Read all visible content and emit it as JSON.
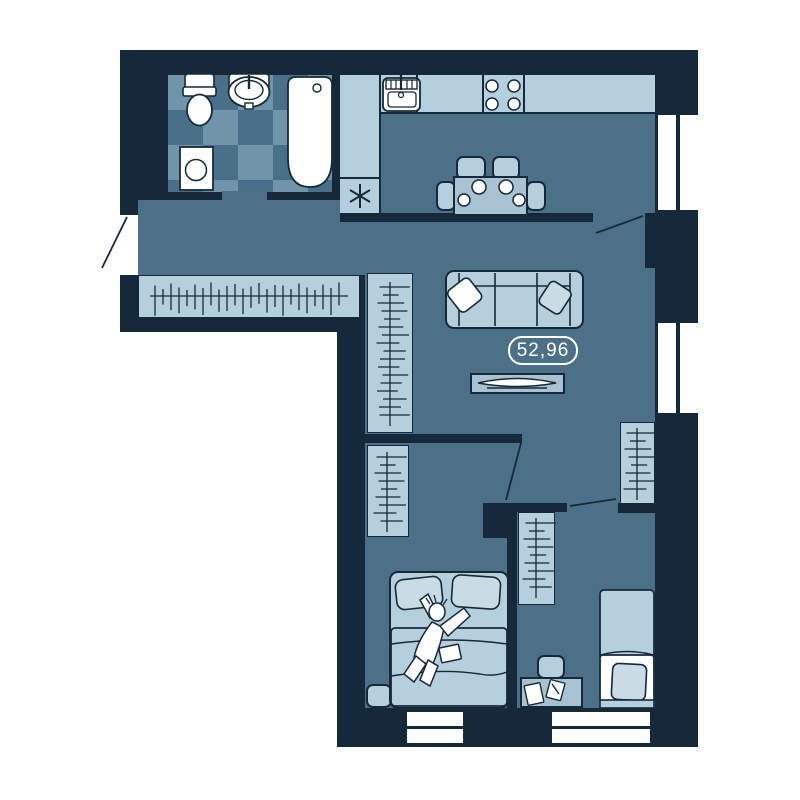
{
  "title": "Apartment floor plan",
  "area_label": {
    "value": "52,96"
  },
  "palette": {
    "wall": "#16293a",
    "floor": "#4b7087",
    "light": "#b6cfdc",
    "mid": "#a8c2d2",
    "pale": "#c9dbe5",
    "tile_light": "#7095aa",
    "tile_dark": "#4a7089",
    "white": "#ffffff"
  },
  "rooms": {
    "bathroom": {
      "fixtures": [
        "toilet",
        "washbasin",
        "bathtub",
        "washing-machine",
        "checker-tiled-floor"
      ]
    },
    "hallway": {
      "fixtures": [
        "entrance-door",
        "coat-rack"
      ]
    },
    "kitchen": {
      "fixtures": [
        "counter",
        "kitchen-sink",
        "stove-4-burner",
        "refrigerator-asterisk",
        "dining-table",
        "four-chairs",
        "door"
      ]
    },
    "living_room": {
      "fixtures": [
        "sofa",
        "two-pillows",
        "tv-stand",
        "wardrobe"
      ],
      "area_label": "52,96"
    },
    "bedroom_1": {
      "fixtures": [
        "double-bed",
        "person-on-bed",
        "two-wardrobes",
        "nightstand",
        "pouf",
        "door"
      ]
    },
    "bedroom_2": {
      "fixtures": [
        "single-bed",
        "desk",
        "desk-chair",
        "papers",
        "wardrobe",
        "door"
      ]
    }
  },
  "windows": {
    "right_wall": 2,
    "bottom_wall": 2
  }
}
